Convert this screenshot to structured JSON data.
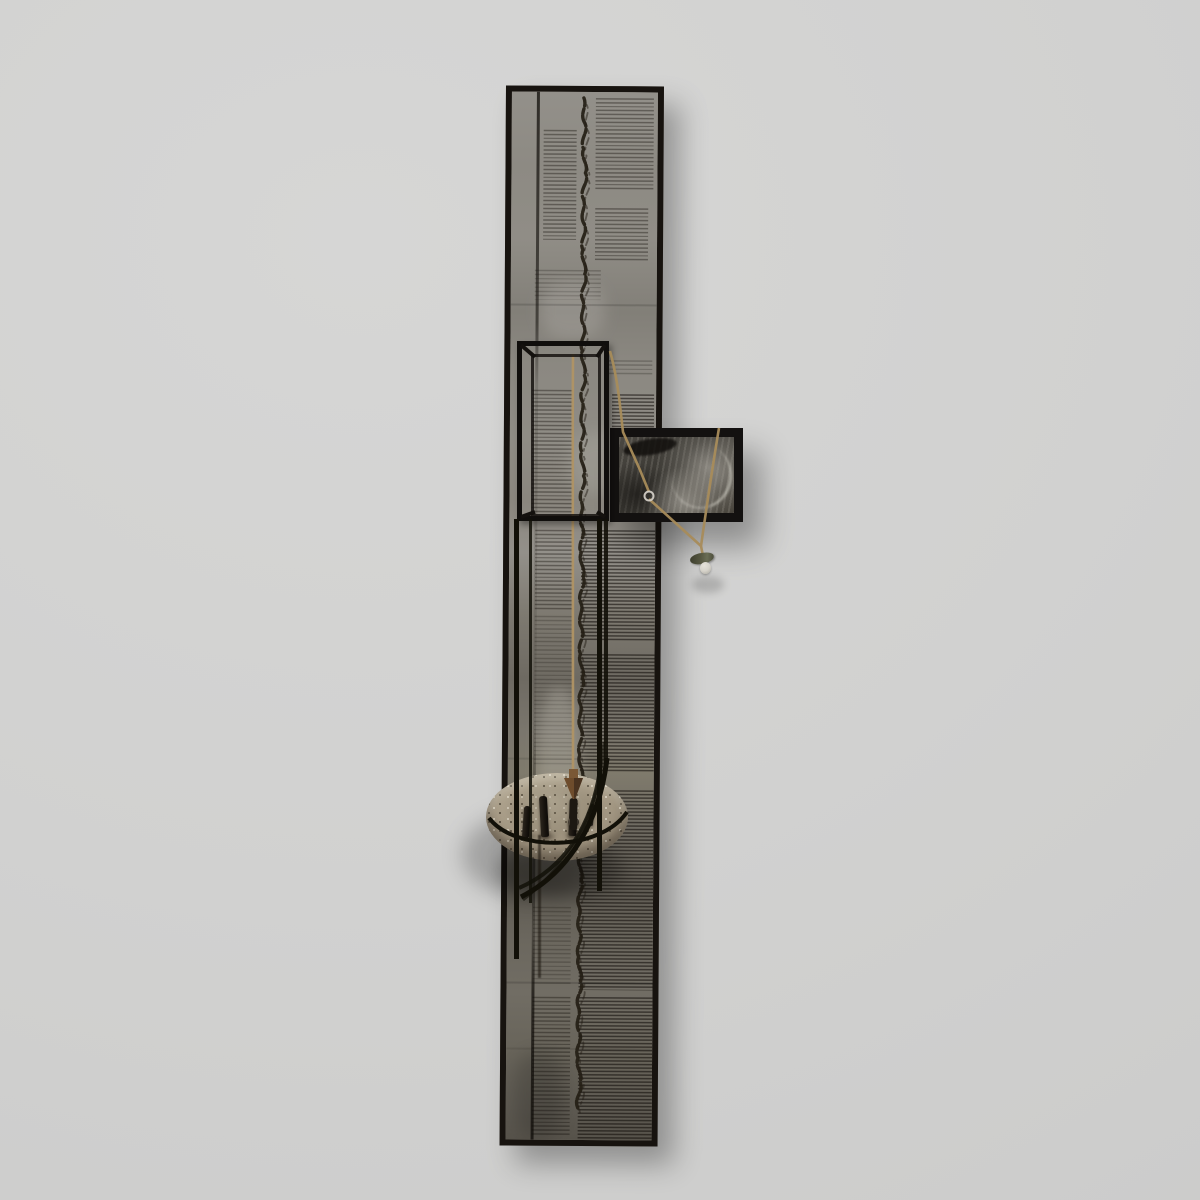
{
  "image": {
    "kind": "photograph-of-artwork",
    "label": "Photograph of a tall vertical mixed-media assemblage artwork hanging on a light gray gallery wall"
  },
  "palette": {
    "wall": "#d2d2d2",
    "frame_black": "#17130f",
    "collage_mid_gray": "#8b877f",
    "collage_dark_gray": "#57534b",
    "newsprint_ink": "#1f1a14",
    "twine_tan": "#ab8f5e",
    "plate_stone": "#a89d88",
    "bob_bronze": "#6e4c2c",
    "photo_silver": "#9a958c",
    "charm_green": "#565741",
    "bead_white": "#d6d3ca"
  },
  "components": {
    "wall": {
      "label": "light gray gallery wall"
    },
    "panel": {
      "label": "tall black-framed panel collaged with aged newsprint columns"
    },
    "script_line": {
      "label": "vertical line of dark handwritten script running down the center of the panel"
    },
    "side_line": {
      "label": "thin dark vertical painted line along the left of the panel"
    },
    "cage": {
      "label": "black welded-wire box cage protruding from the panel"
    },
    "cage_lower": {
      "label": "black wire rails continuing down the panel below the cage"
    },
    "photo_frame": {
      "label": "small black-framed abstract silvery photograph mounted to the right"
    },
    "photo_image": {
      "label": "dark scratched silvery abstract photograph"
    },
    "twine": {
      "label": "tan twine strings crossing the photograph through a small metal ring"
    },
    "ring": {
      "label": "small metal ring threaded on the twine"
    },
    "charm": {
      "label": "small green charm with a white bead hanging from the twine"
    },
    "hanging_string": {
      "label": "tan string hanging inside the cage"
    },
    "plumb_bob": {
      "label": "bronze plumb bob hanging from the string onto the plate"
    },
    "plate": {
      "label": "oval speckled stone plate resting on a curved wire bracket"
    },
    "bracket": {
      "label": "curved black wire bracket supporting the plate"
    },
    "figures": {
      "label": "small dark upright figures and a ball standing on the plate"
    }
  }
}
